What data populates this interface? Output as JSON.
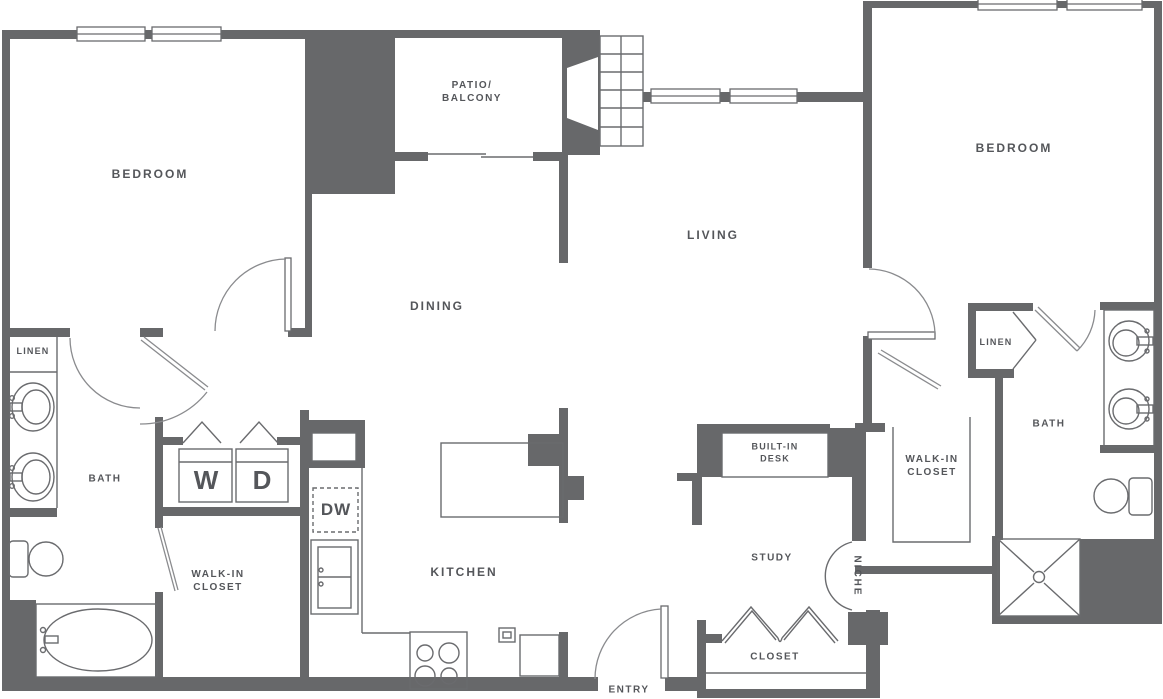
{
  "floorplan": {
    "type": "apartment-floor-plan",
    "colors": {
      "wall": "#67686a",
      "line": "#6a6b6e",
      "arc": "#8a8b8e",
      "text": "#54565a",
      "background": "#ffffff"
    },
    "rooms": {
      "bedroom_left": "BEDROOM",
      "bedroom_right": "BEDROOM",
      "patio_line1": "PATIO/",
      "patio_line2": "BALCONY",
      "living": "LIVING",
      "dining": "DINING",
      "kitchen": "KITCHEN",
      "bath_left": "BATH",
      "bath_right": "BATH",
      "linen_left": "LINEN",
      "linen_right": "LINEN",
      "walkin_left_line1": "WALK-IN",
      "walkin_left_line2": "CLOSET",
      "walkin_right_line1": "WALK-IN",
      "walkin_right_line2": "CLOSET",
      "study": "STUDY",
      "desk_line1": "BUILT-IN",
      "desk_line2": "DESK",
      "niche": "NICHE",
      "closet": "CLOSET",
      "entry": "ENTRY"
    },
    "appliances": {
      "washer": "W",
      "dryer": "D",
      "dishwasher": "DW"
    },
    "fixtures": [
      "fireplace-icon",
      "hearth-tile-grid-icon",
      "window-icon",
      "door-arc-icon",
      "bifold-door-icon",
      "sliding-door-icon",
      "sink-icon",
      "toilet-icon",
      "bathtub-icon",
      "shower-icon",
      "stove-icon",
      "refrigerator-icon",
      "kitchen-sink-icon",
      "kitchen-island",
      "vanity-counter"
    ]
  }
}
